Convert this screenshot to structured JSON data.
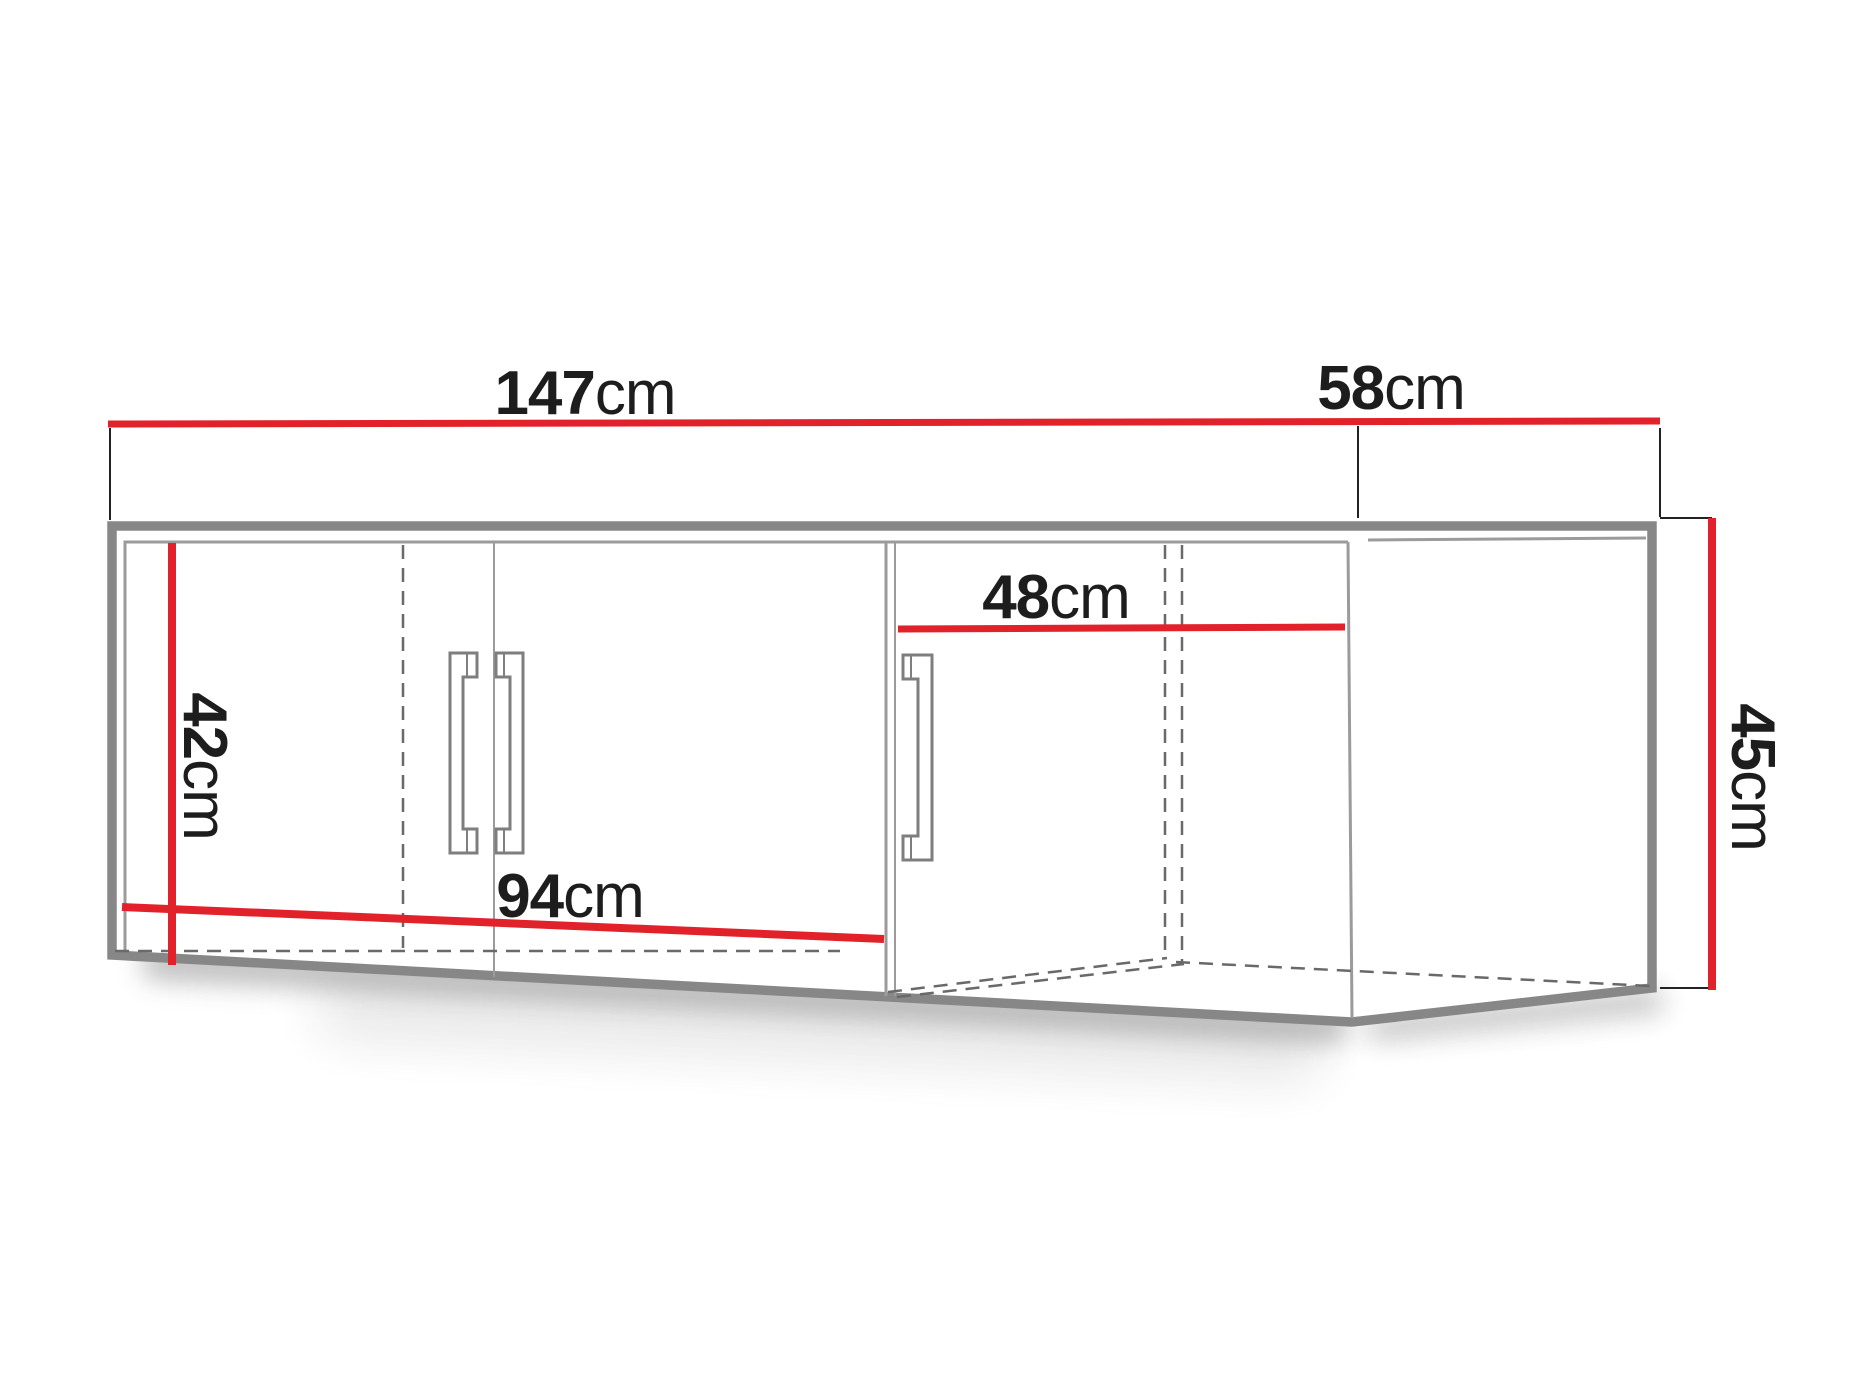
{
  "diagram": {
    "kind": "furniture-dimension-diagram",
    "subject": "corner wall cabinet with three doors, front perspective view"
  },
  "colors": {
    "dimension_red": "#e2222b",
    "outline_gray": "#878787",
    "panel_line_gray": "#9b9b9b",
    "hidden_line_gray": "#696969",
    "handle_gray": "#7e7e7e",
    "tick_black": "#222222",
    "text_black": "#1d1d1d"
  },
  "dimensions": {
    "front_width": {
      "value": "147",
      "unit": "cm"
    },
    "side_depth": {
      "value": "58",
      "unit": "cm"
    },
    "corner_inner_width": {
      "value": "48",
      "unit": "cm"
    },
    "interior_height": {
      "value": "42",
      "unit": "cm"
    },
    "left_inner_width": {
      "value": "94",
      "unit": "cm"
    },
    "side_height": {
      "value": "45",
      "unit": "cm"
    }
  }
}
